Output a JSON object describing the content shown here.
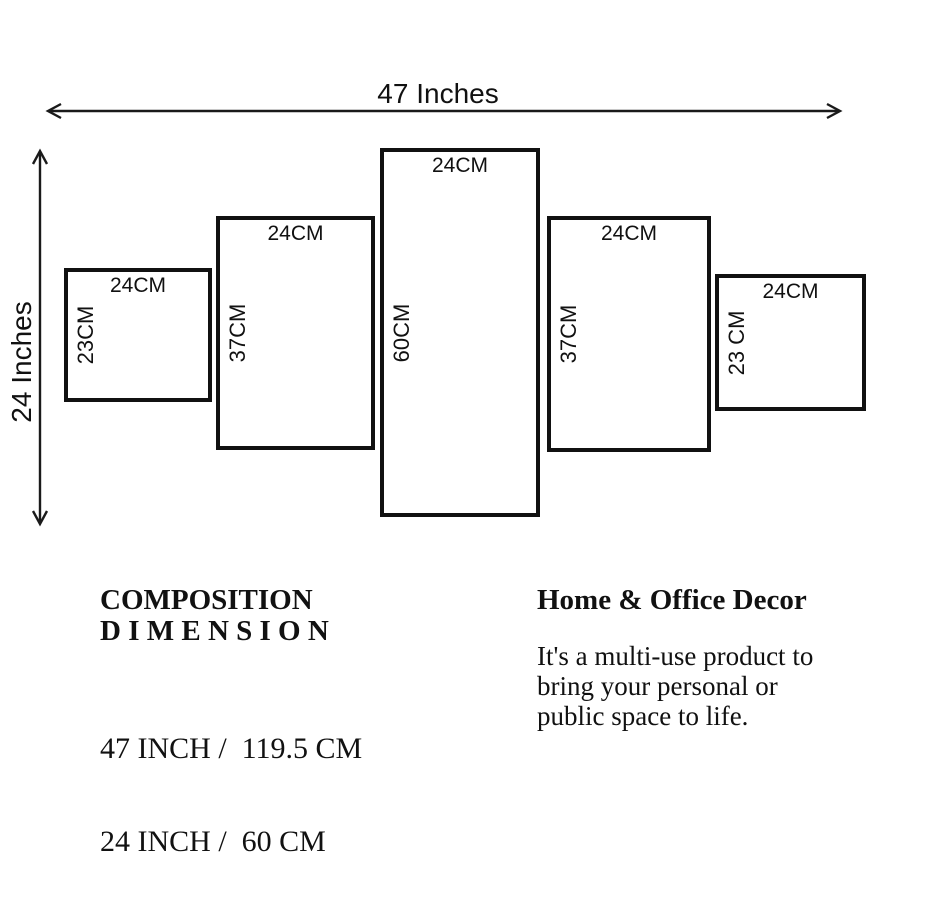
{
  "diagram": {
    "width_dimension": {
      "label": "47 Inches"
    },
    "height_dimension": {
      "label": "24 Inches"
    },
    "panels": [
      {
        "width_label": "24CM",
        "height_label": "23CM"
      },
      {
        "width_label": "24CM",
        "height_label": "37CM"
      },
      {
        "width_label": "24CM",
        "height_label": "60CM"
      },
      {
        "width_label": "24CM",
        "height_label": "37CM"
      },
      {
        "width_label": "24CM",
        "height_label": "23 CM"
      }
    ]
  },
  "info": {
    "composition": {
      "title_line1": "COMPOSITION",
      "title_line2": "D I M E N S I O N",
      "dim_line1": "47 INCH /  119.5 CM",
      "dim_line2": "24 INCH /  60 CM"
    },
    "decor": {
      "title": "Home & Office Decor",
      "body_line1": "It's a multi-use product to",
      "body_line2": "bring your personal or",
      "body_line3": "public space to life."
    }
  },
  "colors": {
    "ink": "#111111",
    "background": "#ffffff"
  }
}
